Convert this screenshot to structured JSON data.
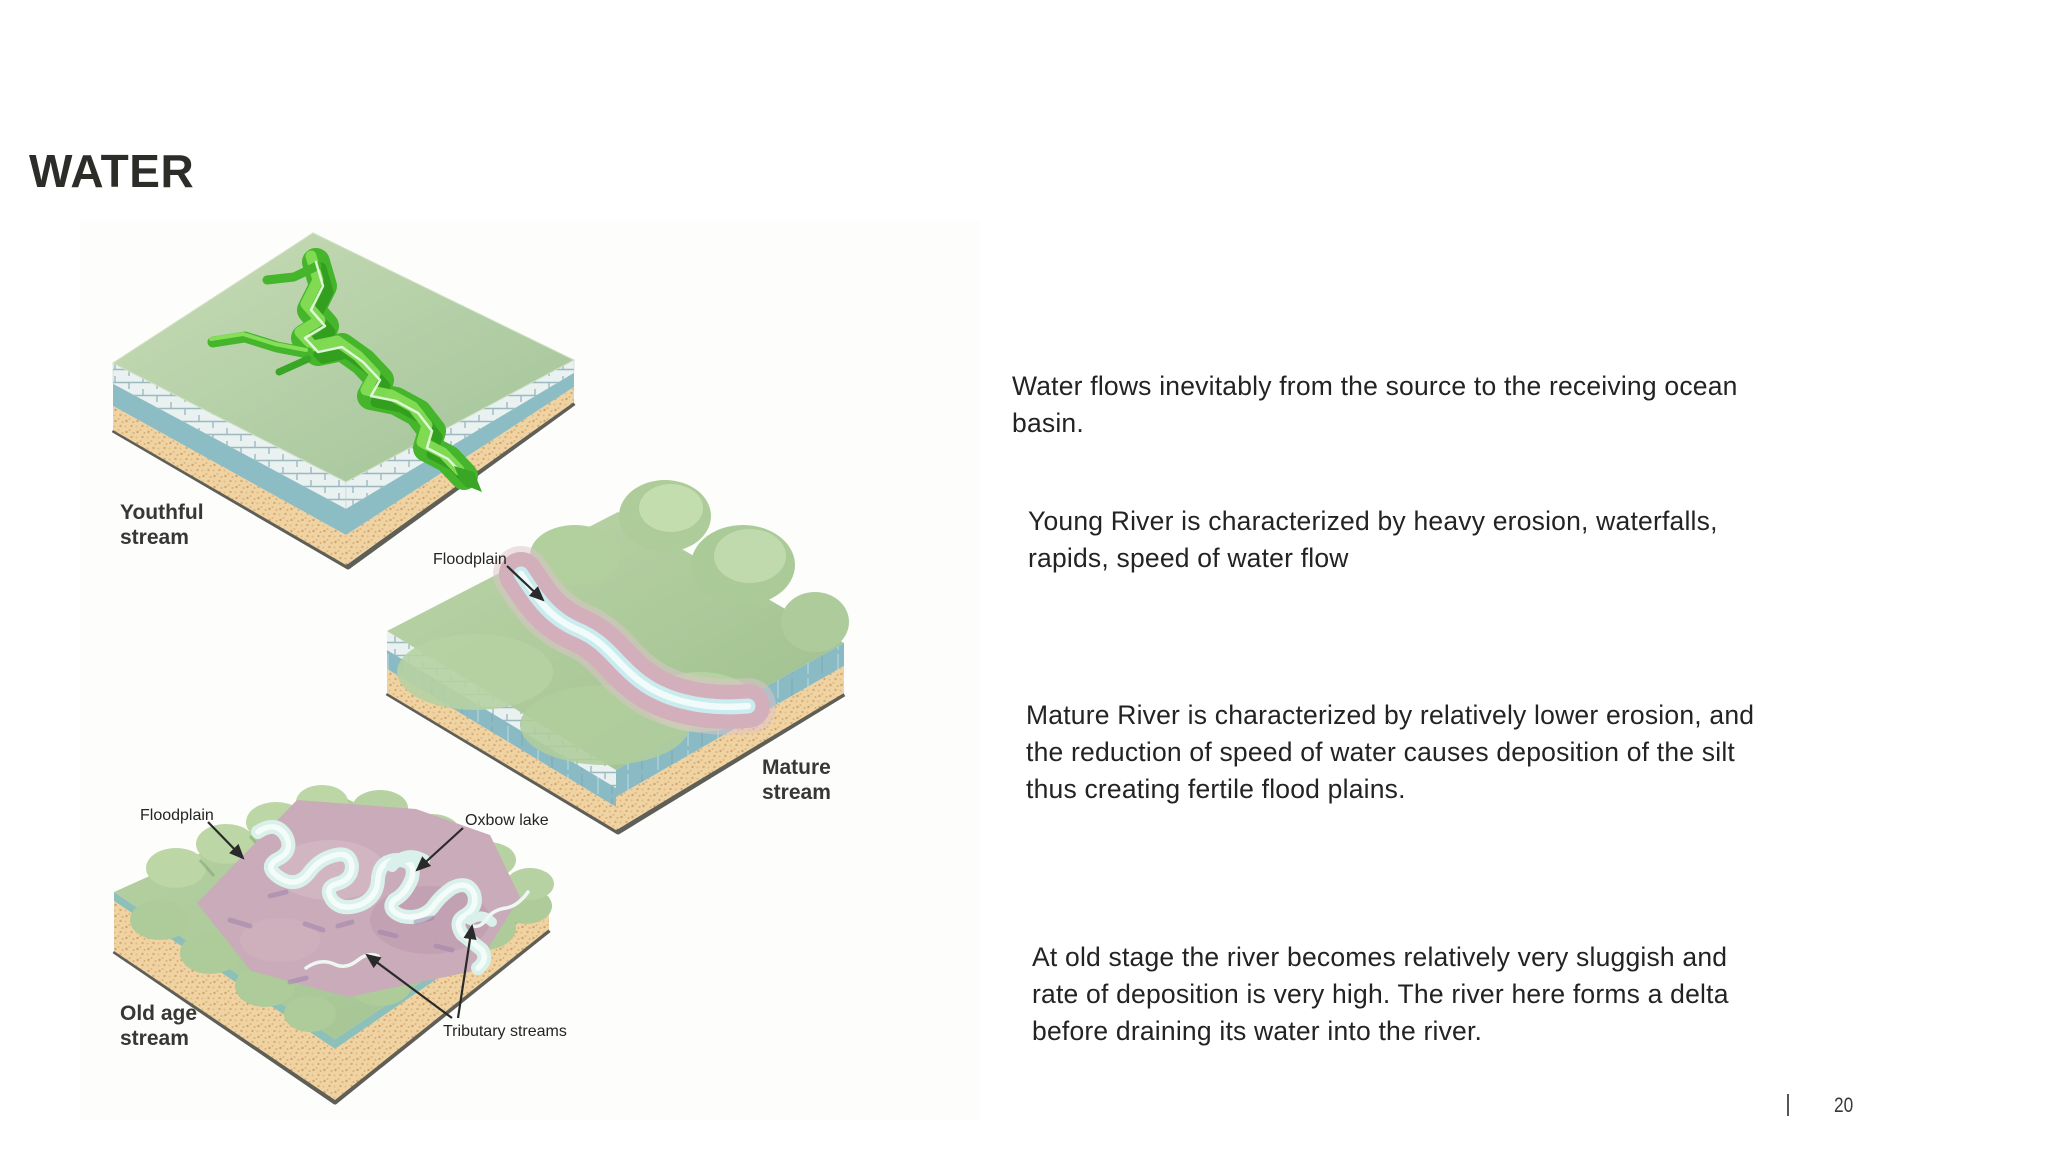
{
  "slide": {
    "title": "WATER",
    "page_number": "20",
    "footer_separator": "|"
  },
  "paragraphs": [
    "Water flows inevitably from the source to the receiving ocean\nbasin.",
    "Young River is characterized by heavy erosion, waterfalls,\nrapids, speed of water flow",
    "Mature River is characterized by relatively lower erosion, and\nthe reduction of speed of water causes deposition of the silt\nthus creating fertile flood plains.",
    "At old stage the river becomes relatively very sluggish and\nrate of deposition is very high. The river here forms a delta\nbefore draining its water into the river."
  ],
  "diagram": {
    "labels": {
      "youthful_line1": "Youthful",
      "youthful_line2": "stream",
      "mature_line1": "Mature",
      "mature_line2": "stream",
      "oldage_line1": "Old age",
      "oldage_line2": "stream",
      "floodplain_mature": "Floodplain",
      "floodplain_old": "Floodplain",
      "oxbow_lake": "Oxbow lake",
      "tributary_streams": "Tributary streams"
    },
    "colors": {
      "grass_light": "#c6dab4",
      "grass_mid": "#a5c695",
      "canyon_green": "#45b52c",
      "rock_brick": "#e9f1f1",
      "rock_teal": "#8cbcc4",
      "sand": "#f0d3a2",
      "floodplain_pink": "#d0adba",
      "river_cyan": "#d6f0ee",
      "label_dark": "#373737"
    }
  }
}
